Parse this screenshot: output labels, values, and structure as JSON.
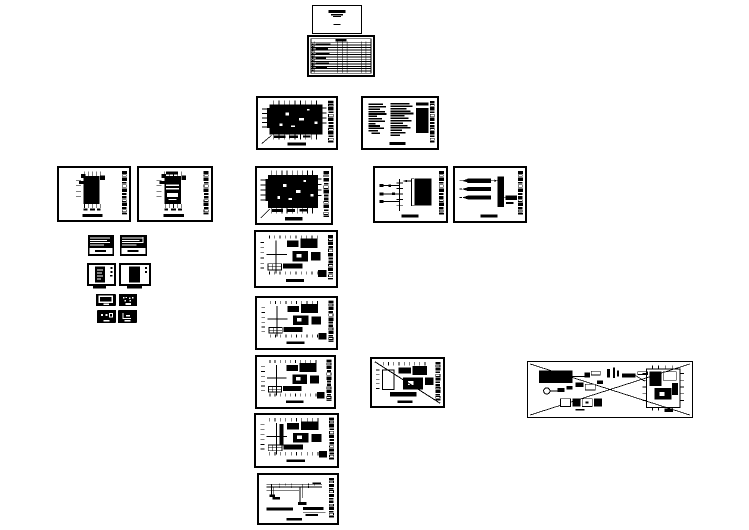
{
  "canvas": {
    "background_color": "#ffffff",
    "ink_color": "#000000",
    "content": "CAD drawing set preview; sheet text too small to be legible"
  },
  "sheets": [
    {
      "name": "cover-sheet"
    },
    {
      "name": "sheet-index-table"
    },
    {
      "name": "floor-plan-dense-1"
    },
    {
      "name": "general-notes-sheet"
    },
    {
      "name": "partial-plan-left-1"
    },
    {
      "name": "partial-plan-left-2"
    },
    {
      "name": "floor-plan-dense-2"
    },
    {
      "name": "riser-detail-1"
    },
    {
      "name": "riser-detail-2"
    },
    {
      "name": "mini-schedule-1"
    },
    {
      "name": "mini-schedule-2"
    },
    {
      "name": "legend-block-1"
    },
    {
      "name": "legend-block-2"
    },
    {
      "name": "thumbnail-1"
    },
    {
      "name": "thumbnail-2"
    },
    {
      "name": "thumbnail-3"
    },
    {
      "name": "thumbnail-4"
    },
    {
      "name": "floor-plan-cross-1"
    },
    {
      "name": "floor-plan-cross-2"
    },
    {
      "name": "floor-plan-cross-3"
    },
    {
      "name": "floor-plan-crossed-out"
    },
    {
      "name": "floor-plan-cross-4"
    },
    {
      "name": "voided-layout-wide"
    },
    {
      "name": "system-schematic"
    }
  ]
}
